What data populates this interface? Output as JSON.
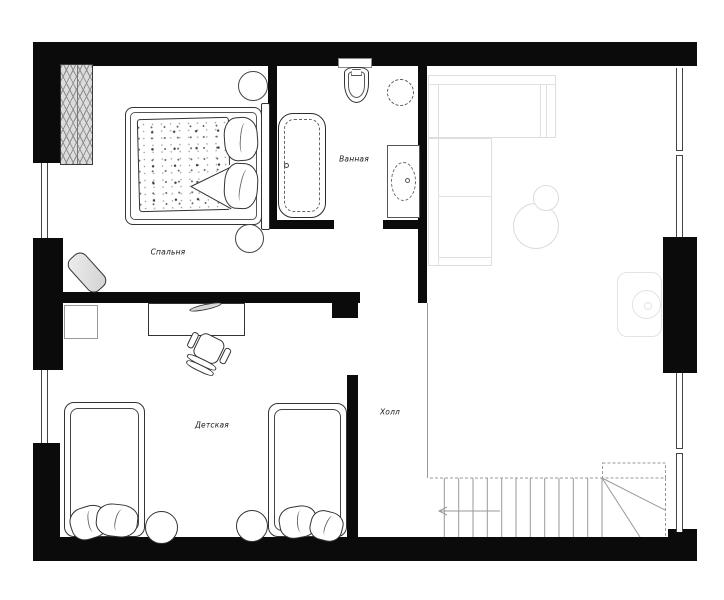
{
  "plan": {
    "type": "apartment-floor-plan",
    "rooms": [
      {
        "id": "bedroom",
        "label": "Спальня"
      },
      {
        "id": "bathroom",
        "label": "Ванная"
      },
      {
        "id": "kids_room",
        "label": "Детская"
      },
      {
        "id": "hall",
        "label": "Холл"
      }
    ],
    "colors": {
      "background": "#ffffff",
      "walls": "#0b0b0b",
      "furniture_line": "#333333",
      "light_furniture_line": "#dedede",
      "window_line": "#444444"
    }
  }
}
